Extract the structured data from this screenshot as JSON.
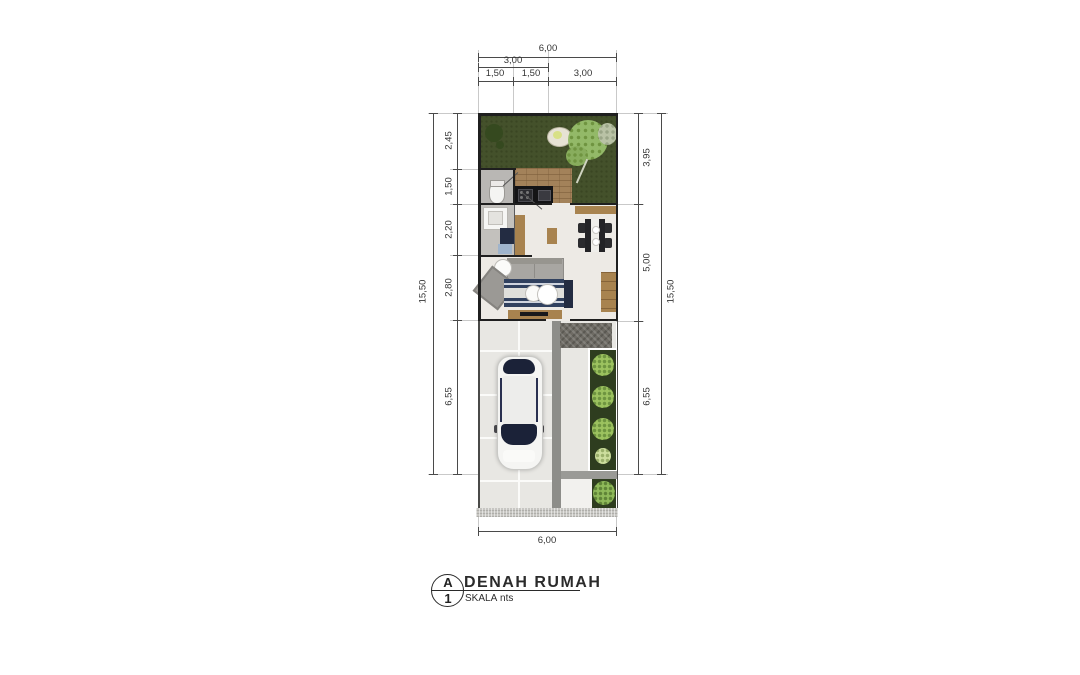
{
  "title_block": {
    "sheet_letter": "A",
    "sheet_number": "1",
    "title": "DENAH RUMAH",
    "scale_label": "SKALA",
    "scale_value": "nts"
  },
  "dims": {
    "top_total": "6,00",
    "top_mid": "3,00",
    "top_seg1": "1,50",
    "top_seg2": "1,50",
    "top_seg3": "3,00",
    "bottom_total": "6,00",
    "left_total": "15,50",
    "left_seg1": "2,45",
    "left_seg2": "1,50",
    "left_seg3": "2,20",
    "left_seg4": "2,80",
    "left_seg5": "6,55",
    "right_seg1": "3,95",
    "right_seg2": "5,00",
    "right_seg3": "6,55",
    "right_total": "15,50"
  },
  "colors": {
    "grass": "#44512b",
    "tree_light": "#93b968",
    "deck_wood": "#a3825a",
    "wall": "#1f1f1f",
    "indoor_floor": "#edeae5",
    "carport_tile": "#e8e7e3",
    "path_strip": "#8d8d89",
    "rug_navy": "#31415f",
    "furniture_wood": "#a8834f",
    "planter_green": "#2e3d1f",
    "bush_green": "#9cc25f",
    "car_glass": "#1b2238",
    "dimension_line": "#4a4a4a"
  }
}
